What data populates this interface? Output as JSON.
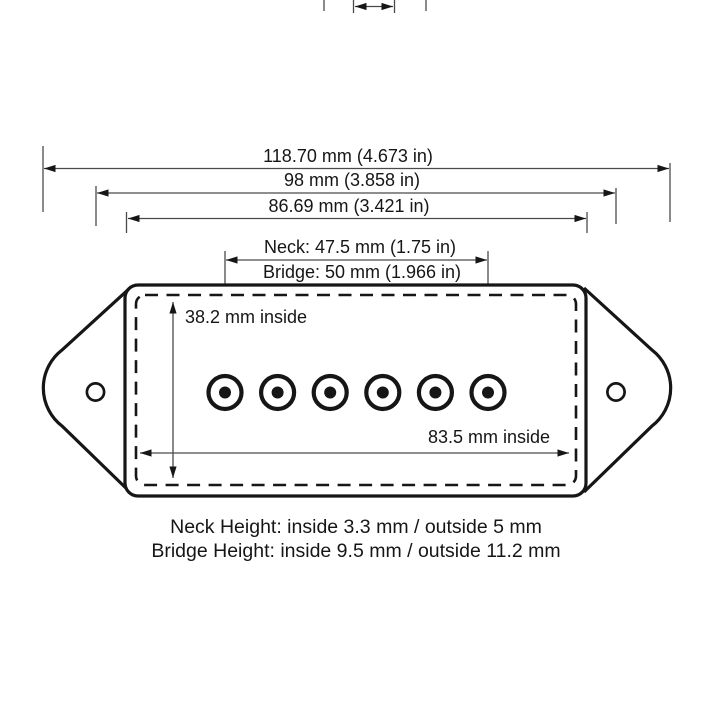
{
  "labels": {
    "overall_width": "118.70 mm (4.673 in)",
    "mounting_width": "98 mm (3.858 in)",
    "body_width": "86.69 mm (3.421 in)",
    "neck_spacing": "Neck: 47.5 mm (1.75 in)",
    "bridge_spacing": "Bridge: 50 mm (1.966 in)",
    "inside_height": "38.2 mm inside",
    "inside_width": "83.5 mm inside"
  },
  "notes": {
    "neck_height": "Neck Height: inside 3.3 mm / outside 5 mm",
    "bridge_height": "Bridge Height: inside 9.5 mm / outside 11.2 mm"
  },
  "drawing": {
    "pole_count": 6,
    "mounting_hole_count": 2
  },
  "colors": {
    "background": "#ffffff",
    "ink": "#161616",
    "dimension_lines": "#4a4a4a"
  }
}
